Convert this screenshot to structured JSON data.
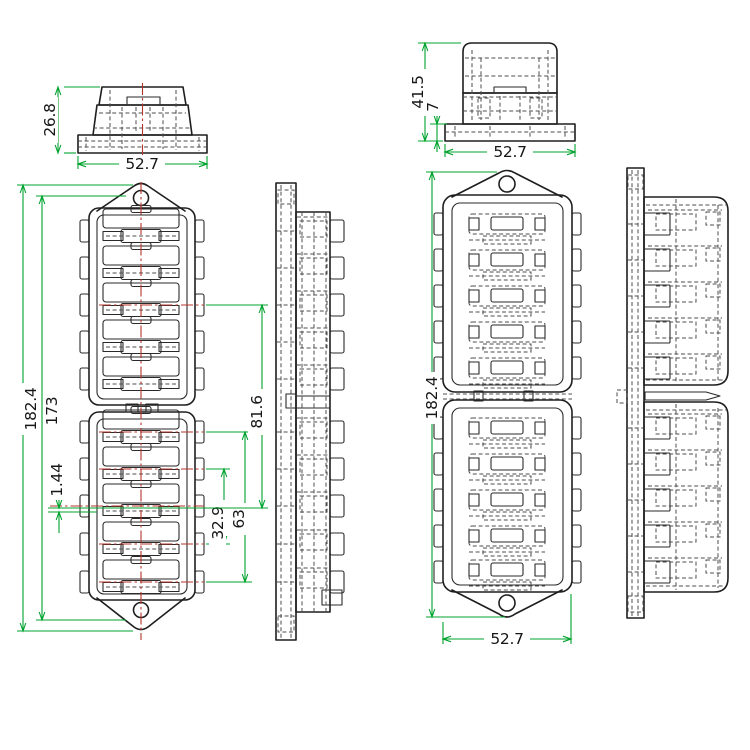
{
  "colors": {
    "outline": "#1e1e1e",
    "hidden_line": "#4e4e4e",
    "dimension": "#00a32e",
    "centerline": "#b5342c",
    "text": "#161616",
    "background": "#ffffff"
  },
  "dimensions": {
    "cover_small": {
      "height": "26.8",
      "width": "52.7"
    },
    "cover_large": {
      "height": "41.5",
      "base_height": "7",
      "width": "52.7"
    },
    "left_view": {
      "overall_height": "182.4",
      "inner_height": "173",
      "slot_offset": "1.44",
      "pitch_double": "32.9",
      "pitch_quad": "63",
      "half_height": "81.6"
    },
    "right_view": {
      "overall_height": "182.4",
      "width": "52.7"
    }
  }
}
